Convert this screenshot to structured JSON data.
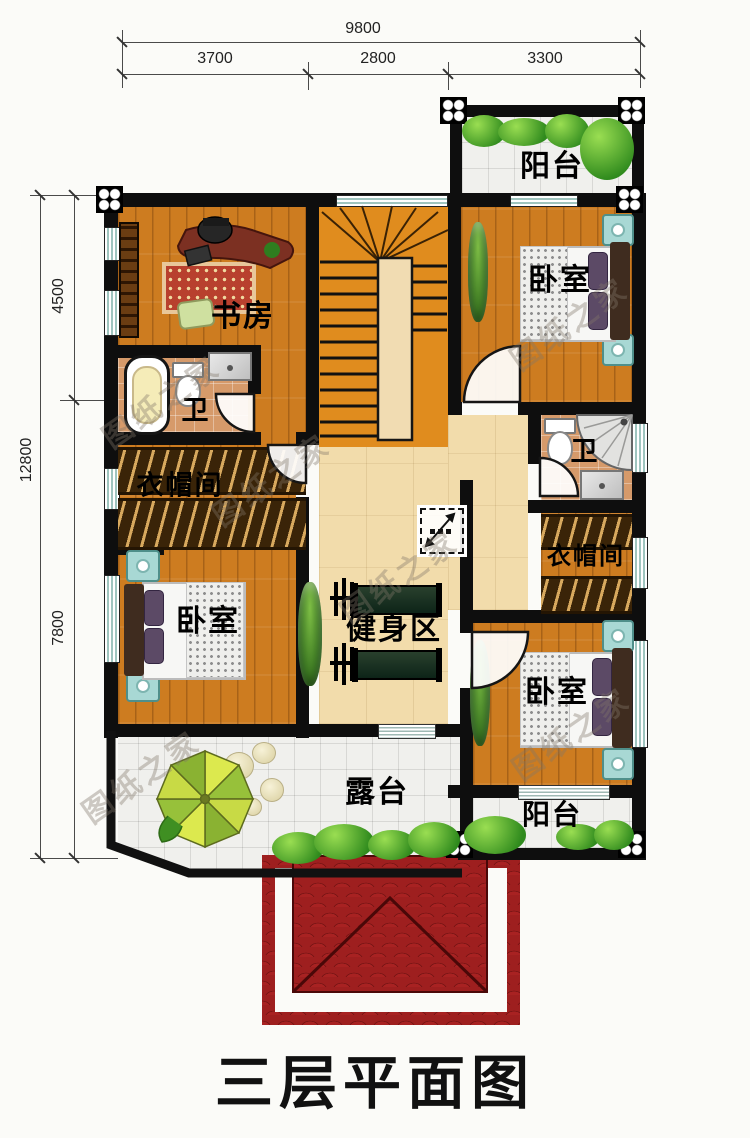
{
  "title": "三层平面图",
  "watermark": "图纸之家",
  "dims": {
    "top": {
      "total": "9800",
      "segments": [
        "3700",
        "2800",
        "3300"
      ]
    },
    "left": {
      "total": "12800",
      "segments": [
        "4500",
        "7800"
      ]
    }
  },
  "rooms": {
    "balcony_top": "阳台",
    "study": "书房",
    "bedroom_top_right": "卧室",
    "bath_left": "卫",
    "closet_left": "衣帽间",
    "bedroom_bottom_left": "卧室",
    "gym": "健身区",
    "bath_right": "卫",
    "closet_right": "衣帽间",
    "bedroom_bottom_right": "卧室",
    "terrace": "露台",
    "balcony_bottom": "阳台"
  },
  "colors": {
    "wall": "#0e0e0e",
    "wood_floor": "#cd7c20",
    "hall_floor": "#f2dcab",
    "tile_floor": "#f0f0ed",
    "bath_floor": "#d69a6a",
    "roof_red": "#9e1f1f",
    "greenery": "#2f8a1d",
    "nightstand_teal": "#a8d8d4"
  }
}
